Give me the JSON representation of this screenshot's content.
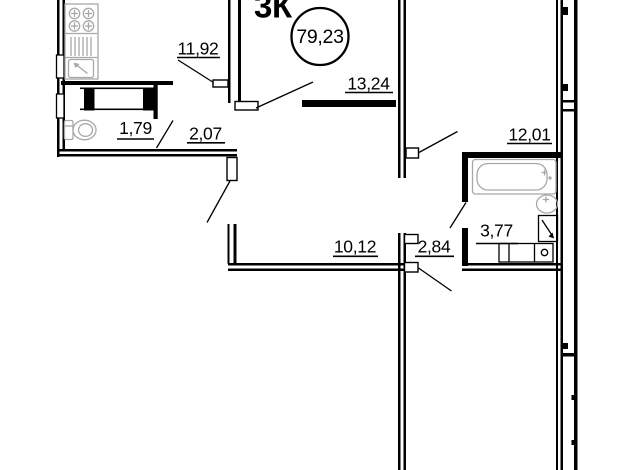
{
  "plan": {
    "title": "3К",
    "total_area": "79,23",
    "rooms": [
      {
        "id": "kitchen",
        "area": "11,92"
      },
      {
        "id": "living-room",
        "area": "13,24"
      },
      {
        "id": "bedroom-right",
        "area": "12,01"
      },
      {
        "id": "wc",
        "area": "1,79"
      },
      {
        "id": "hallway",
        "area": "2,07"
      },
      {
        "id": "bedroom-left",
        "area": "10,12"
      },
      {
        "id": "corridor",
        "area": "2,84"
      },
      {
        "id": "bathroom",
        "area": "3,77"
      }
    ],
    "colors": {
      "wall": "#000000",
      "fixture": "#a8a8a8",
      "background": "#ffffff"
    }
  }
}
